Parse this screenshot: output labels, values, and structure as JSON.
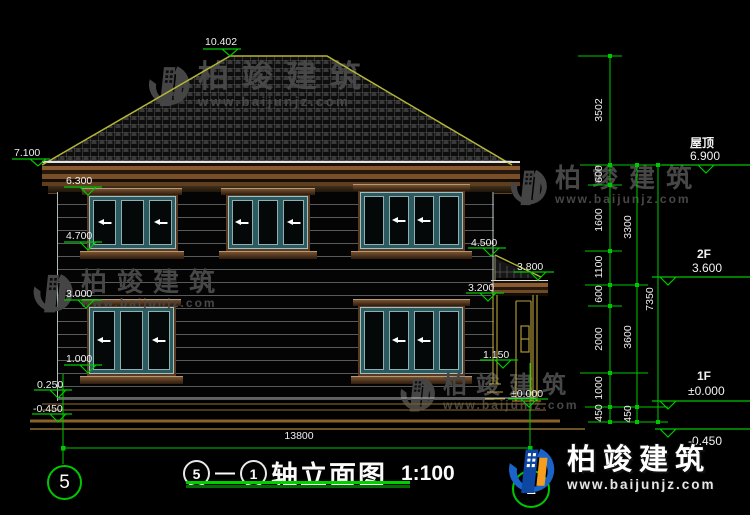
{
  "drawing": {
    "type": "elevation",
    "scale_note": "1:100"
  },
  "levels_left": [
    "10.402",
    "7.100",
    "6.300",
    "4.700",
    "3.000",
    "1.000",
    "0.250",
    "-0.450"
  ],
  "levels_mid": [
    "4.500",
    "3.800",
    "3.200",
    "1.150",
    "±0.000"
  ],
  "levels_right": [
    {
      "label": "屋顶",
      "value": "6.900"
    },
    {
      "label": "2F",
      "value": "3.600"
    },
    {
      "label": "1F",
      "value": "±0.000"
    },
    {
      "label": "",
      "value": "-0.450"
    }
  ],
  "dims": {
    "chain_a": [
      "3502",
      "600",
      "1600",
      "1100",
      "600",
      "2000",
      "1000",
      "450"
    ],
    "chain_b": [
      "3300",
      "3600",
      "450"
    ],
    "total": "7350",
    "width": "13800"
  },
  "axes": {
    "left": "5",
    "right": "1"
  },
  "title": {
    "from": "5",
    "dash": "—",
    "to": "1",
    "text": "轴立面图",
    "scale": "1:100"
  },
  "wm": {
    "brand": "柏竣建筑",
    "url": "www.baijunjz.com"
  },
  "logo": {
    "brand": "柏竣建筑",
    "url": "www.baijunjz.com"
  },
  "colors": {
    "dimension_green": "#00c800",
    "roof_outline": "#b5b535",
    "logo_blue": "#1a63c8",
    "logo_orange": "#f59d1e"
  }
}
